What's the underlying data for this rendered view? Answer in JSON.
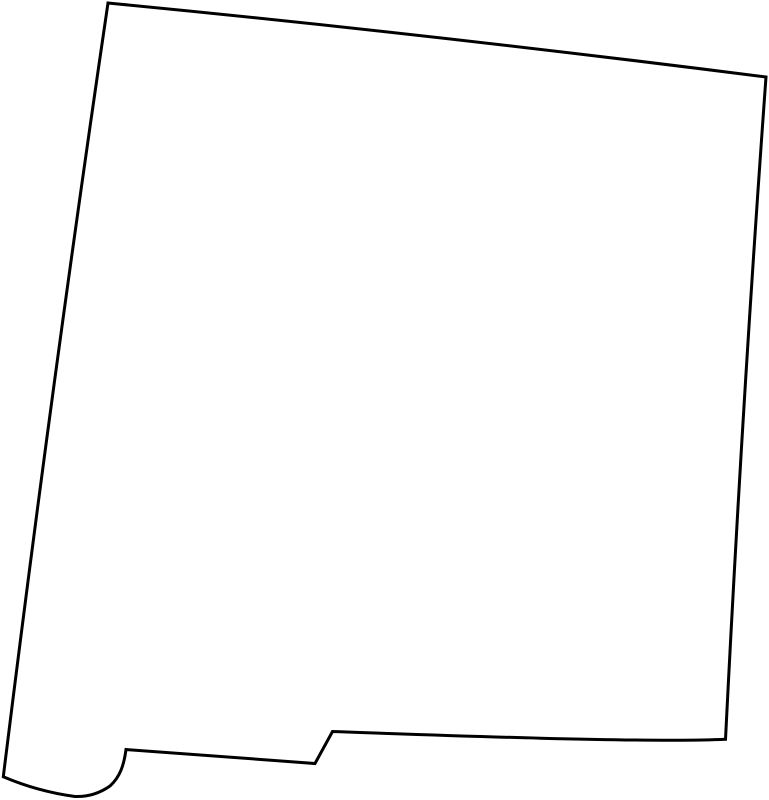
{
  "map": {
    "region": "New Mexico",
    "type": "state-outline",
    "background_color": "#ffffff",
    "fill_color": "#ffffff",
    "stroke_color": "#000000",
    "stroke_width": 3,
    "viewbox": "0 0 769 800",
    "outline_path": "M 108 3 Q 420 33 766 77 Q 742 408 725.5 739.3 C 650 743 430 735 332.5 731.5 L 315 763.5 L 126 749.5 C 124 765 120 777 110 786 C 100 793 88 797 75 796.5 C 50 793 25 786 3.3 776.7 Q 51 390 108 3 Z",
    "key_points": {
      "top_left": [
        108,
        3
      ],
      "top_right": [
        766,
        77
      ],
      "bottom_right": [
        725.5,
        739.3
      ],
      "el_paso_step_top": [
        332.5,
        731.5
      ],
      "el_paso_step_bottom": [
        315,
        763.5
      ],
      "bootheel_notch_corner": [
        126,
        749.5
      ],
      "bootheel_bottom": [
        88,
        796.5
      ],
      "bottom_left": [
        3.3,
        776.7
      ]
    }
  }
}
